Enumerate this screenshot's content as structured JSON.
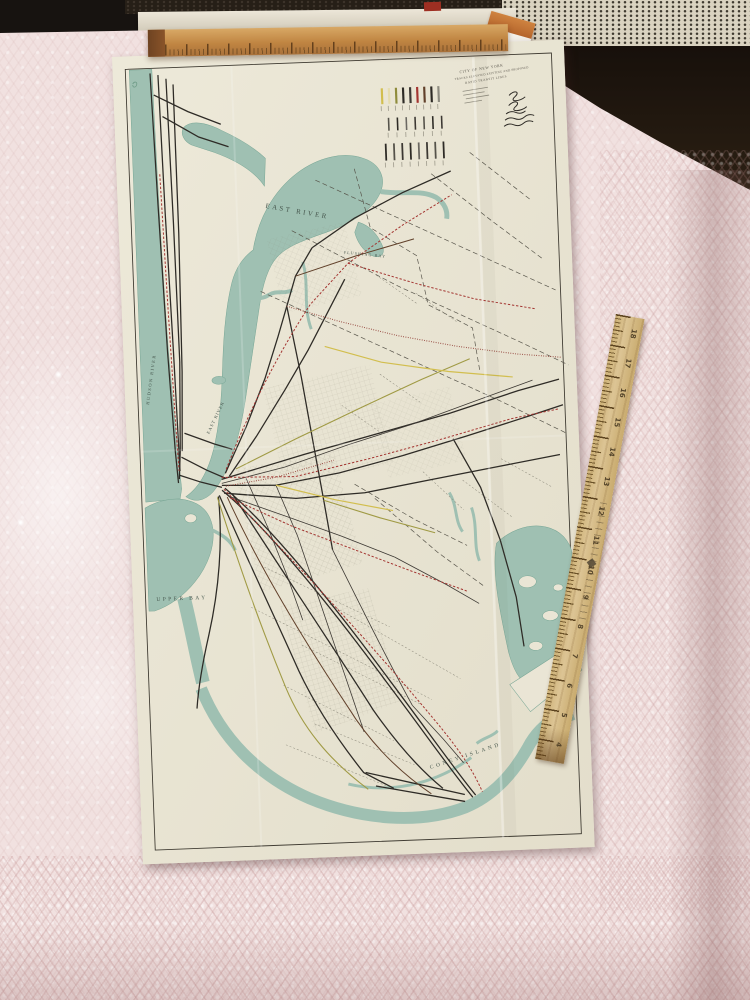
{
  "map": {
    "labels": {
      "east_river_upper": "EAST RIVER",
      "flushing_bay": "FLUSHING BAY",
      "hudson_river": "HUDSON RIVER",
      "east_river_lower": "EAST RIVER",
      "upper_bay": "UPPER BAY",
      "jamaica_bay": "JAMAICA BAY",
      "coney_island": "CONEY ISLAND"
    },
    "title_block": {
      "lines": [
        "CITY OF NEW YORK",
        "TRACKS ELEVATED EXISTING AND PROPOSED",
        "RAPID TRANSIT LINES"
      ]
    },
    "legend": {
      "row1_colors": [
        "#d2be4e",
        "#e6ddae",
        "#8f8c3c",
        "#2e2b26",
        "#3c3833",
        "#a33430",
        "#61402a",
        "#2e2b26",
        "#8d8b80"
      ],
      "row2_colors": [
        "#55524a",
        "#2e2b26",
        "#6b6862",
        "#3c3833",
        "#55524a",
        "#2e2b26",
        "#3c3833"
      ],
      "row3_colors": [
        "#2e2b26",
        "#55524a",
        "#3c3833",
        "#2e2b26",
        "#6b6862",
        "#3c3833",
        "#55524a",
        "#2e2b26"
      ]
    },
    "colors": {
      "paper": "#eae5d5",
      "water": "#9fc0b2",
      "line_black": "#2e2b26",
      "line_red": "#a33430",
      "line_olive": "#a09a44",
      "line_yellow": "#d2be4e",
      "line_brown": "#61402a"
    }
  },
  "rulers": {
    "right": {
      "numbers": [
        "18",
        "17",
        "16",
        "15",
        "14",
        "13",
        "12",
        "11",
        "10",
        "9",
        "8",
        "7",
        "6",
        "5",
        "4"
      ]
    }
  }
}
